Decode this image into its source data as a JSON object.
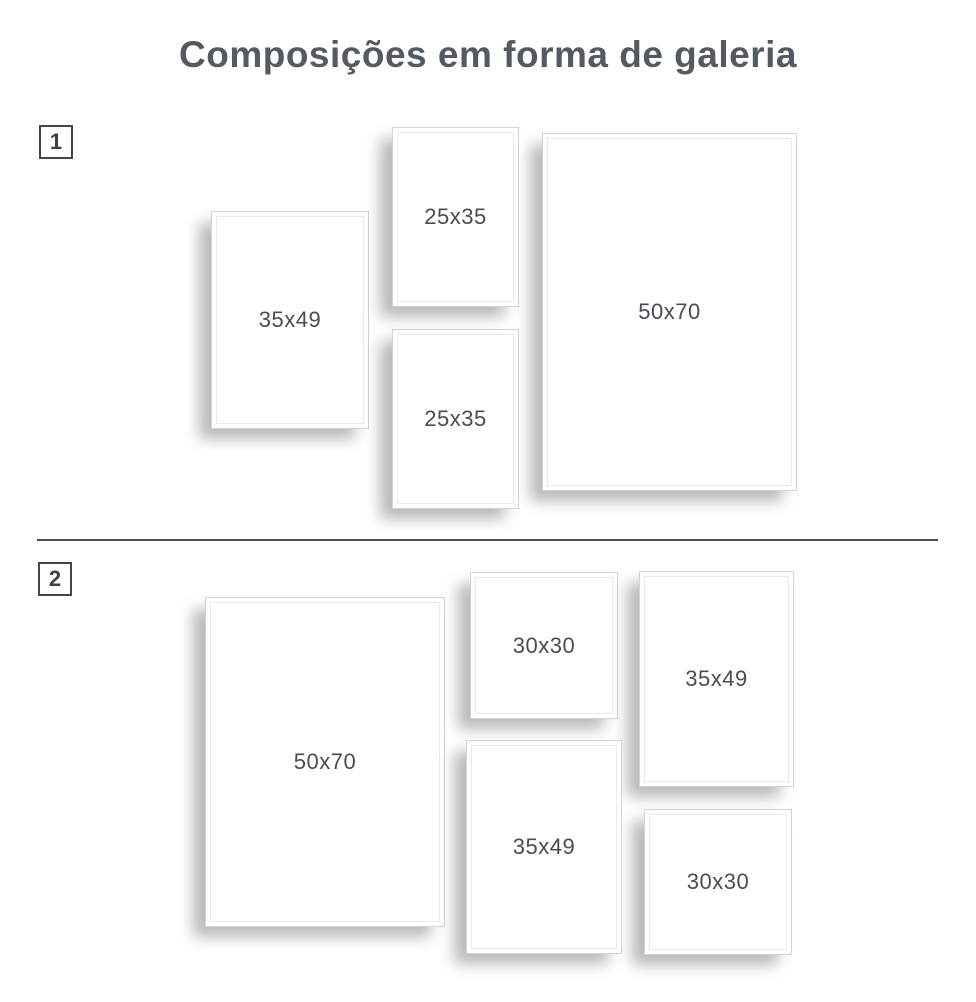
{
  "title": "Composições em forma de galeria",
  "colors": {
    "title": "#545a61",
    "label": "#474d55",
    "badge_border": "#41464c",
    "frame_border": "#d3d3d3",
    "divider": "#4f4f4f",
    "background": "#ffffff"
  },
  "sections": [
    {
      "badge": "1",
      "frames": [
        {
          "label": "35x49"
        },
        {
          "label": "25x35"
        },
        {
          "label": "25x35"
        },
        {
          "label": "50x70"
        }
      ]
    },
    {
      "badge": "2",
      "frames": [
        {
          "label": "50x70"
        },
        {
          "label": "30x30"
        },
        {
          "label": "35x49"
        },
        {
          "label": "35x49"
        },
        {
          "label": "30x30"
        }
      ]
    }
  ]
}
